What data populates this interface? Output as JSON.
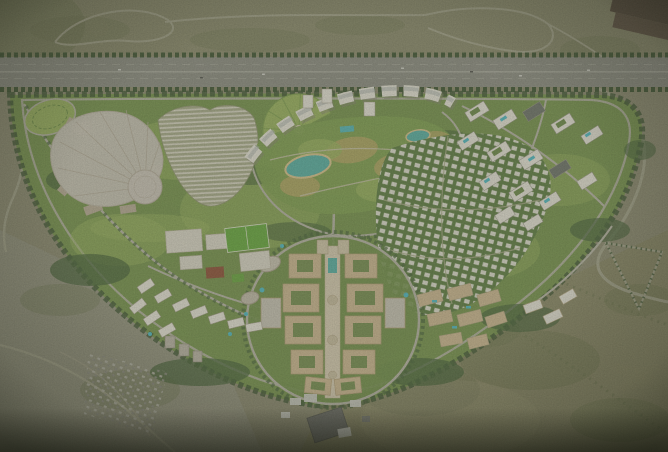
{
  "scene": {
    "type": "aerial-render",
    "description": "Aerial CGI rendering of a crescent-shaped landscaped masterplan city in the desert, bordered on the north by a tree-lined highway, with a fan-shaped convention hall, an arc of apartment blocks, a central park with lagoons, a villa grid, rooftop-pool residential clusters and a symmetric beige downtown around a central promenade axis",
    "regions": {
      "desert": "desert scrubland",
      "highway": "tree-lined highway",
      "development": "landscaped crescent masterplan",
      "convention_center": "fan-shaped hall with circular dome",
      "striped_rows": "dense rows of low-rise units",
      "oval_garden": "oval garden",
      "crescent_apartments": "arc of white apartment buildings",
      "formal_garden": "semicircular radial garden",
      "central_park": "central park with teal lagoons",
      "roof_pool_district": "residential blocks with rooftop pools",
      "villa_district": "diagonal villa grid",
      "downtown": "symmetric downtown blocks with central axis",
      "school_campus": "campus with bright sports field",
      "west_district": "business district slabs",
      "settlements": "scattered desert settlement",
      "sheds": "industrial sheds",
      "triangle_track": "triangular desert road loop",
      "warehouses": "dark warehouses at top right corner"
    },
    "colors": {
      "desert_top": "#8b8a6d",
      "desert_mid": "#8d8b72",
      "desert_left": "#94927f",
      "desert_right": "#8a8766",
      "shrub": "#6e7550",
      "desert_road": "#a5a38c",
      "highway_asphalt": "#8d8d84",
      "highway_lane": "#a6a69b",
      "tree_dark": "#3f5433",
      "tree_green": "#48633a",
      "dev_green": "#76934d",
      "lawn_light": "#9ab35f",
      "lawn_dry": "#b1a663",
      "road_light": "#b7b4a6",
      "building_white": "#e8e5da",
      "building_gray": "#c9c3b6",
      "building_beige": "#cdb892",
      "courtyard_green": "#6d8a4a",
      "water_teal": "#57b0a6",
      "pool_cyan": "#4fb9c4",
      "sand_edge": "#d9c58f",
      "field_green": "#67a83e",
      "red_court": "#8e4f38",
      "warehouse_brown": "#52453a",
      "shed_gray": "#6a6b66",
      "shed_white": "#cfcfc8",
      "axis_paving": "#d8cdb4",
      "dome_gray": "#ccc5ba",
      "stripe_base": "#a8ab8b",
      "villa_green": "#5e7d43",
      "park_green": "#7f9f50"
    }
  }
}
